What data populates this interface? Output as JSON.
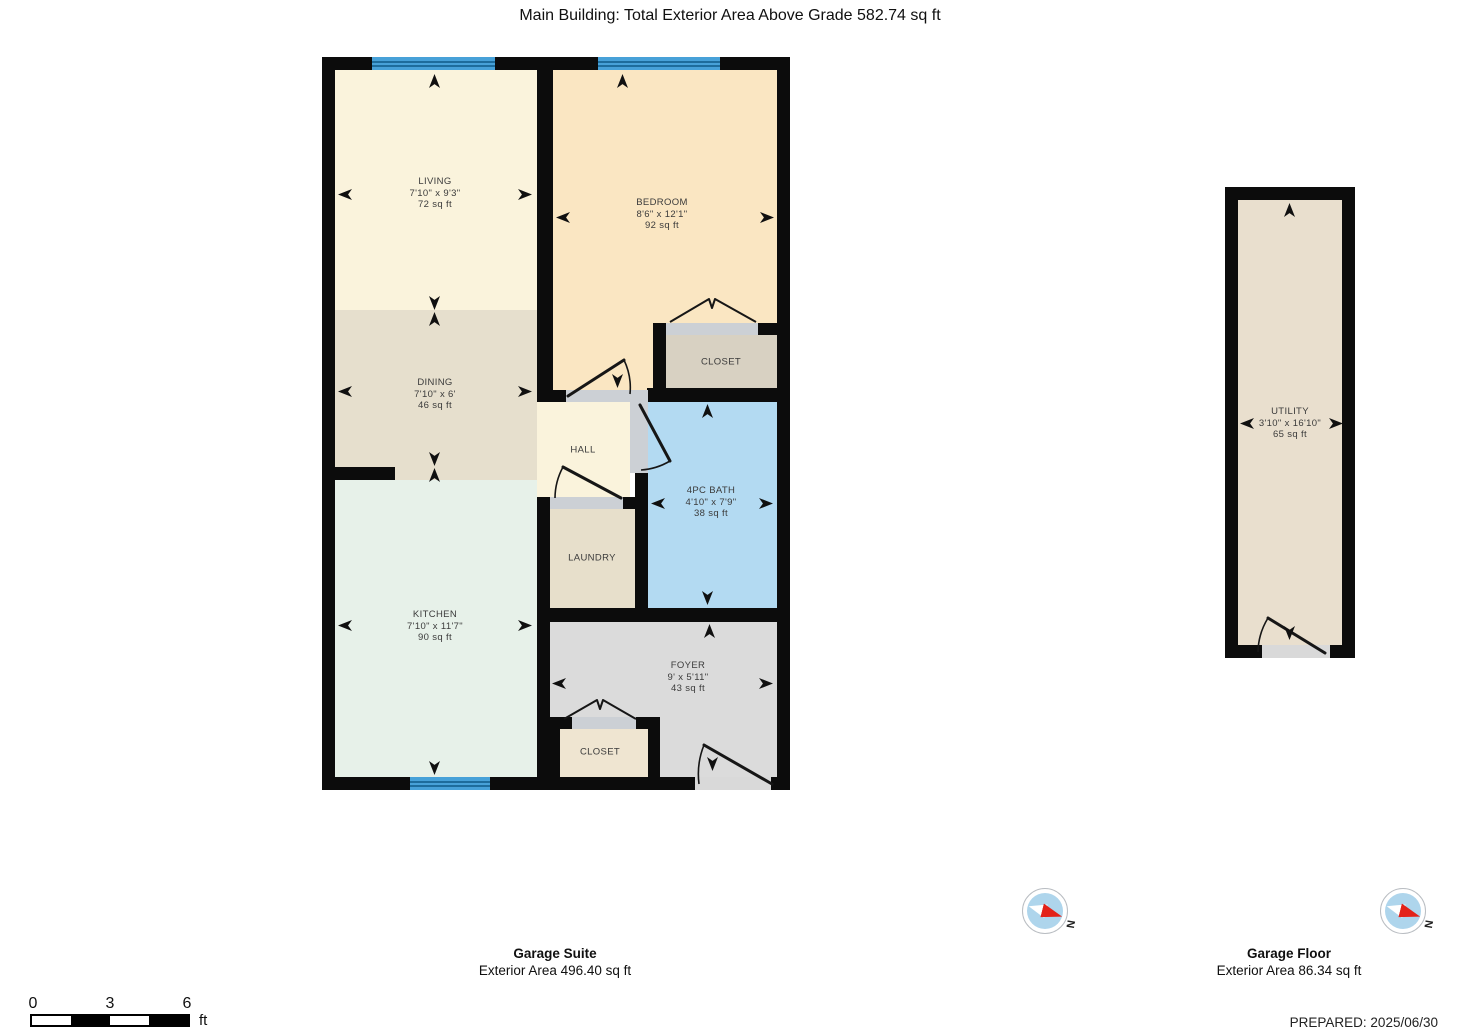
{
  "title": "Main Building: Total Exterior Area Above Grade 582.74 sq ft",
  "plans": {
    "garage_suite": {
      "caption_title": "Garage Suite",
      "caption_area": "Exterior Area 496.40 sq ft",
      "rooms": {
        "living": {
          "name": "LIVING",
          "dims": "7'10\" x 9'3\"",
          "area": "72 sq ft"
        },
        "bedroom": {
          "name": "BEDROOM",
          "dims": "8'6\" x 12'1\"",
          "area": "92 sq ft"
        },
        "dining": {
          "name": "DINING",
          "dims": "7'10\" x 6'",
          "area": "46 sq ft"
        },
        "kitchen": {
          "name": "KITCHEN",
          "dims": "7'10\" x 11'7\"",
          "area": "90 sq ft"
        },
        "bath": {
          "name": "4PC BATH",
          "dims": "4'10\" x 7'9\"",
          "area": "38 sq ft"
        },
        "foyer": {
          "name": "FOYER",
          "dims": "9' x 5'11\"",
          "area": "43 sq ft"
        },
        "hall": {
          "name": "HALL"
        },
        "laundry": {
          "name": "LAUNDRY"
        },
        "closet_bedroom": {
          "name": "CLOSET"
        },
        "closet_foyer": {
          "name": "CLOSET"
        }
      }
    },
    "garage_floor": {
      "caption_title": "Garage Floor",
      "caption_area": "Exterior Area 86.34 sq ft",
      "rooms": {
        "utility": {
          "name": "UTILITY",
          "dims": "3'10\" x 16'10\"",
          "area": "65 sq ft"
        }
      }
    }
  },
  "scale_bar": {
    "ticks": [
      "0",
      "3",
      "6"
    ],
    "unit": "ft"
  },
  "compass": {
    "label": "N"
  },
  "footer": {
    "prepared": "PREPARED: 2025/06/30"
  },
  "colors": {
    "wall": "#0c0c0c",
    "window_blue": "#47a1d8",
    "living": "#faf3dc",
    "bedroom": "#fae6c2",
    "dining": "#e6dfcd",
    "kitchen": "#e7f1e9",
    "bath": "#b3daf2",
    "laundry": "#e7dfcb",
    "foyer": "#dbdbdb",
    "closet_bedroom": "#d8d1c2",
    "closet_foyer": "#efe5d1",
    "utility": "#e9dfce",
    "threshold": "#ccd0d5",
    "compass_red": "#e32219",
    "compass_face": "#aed5ec"
  }
}
